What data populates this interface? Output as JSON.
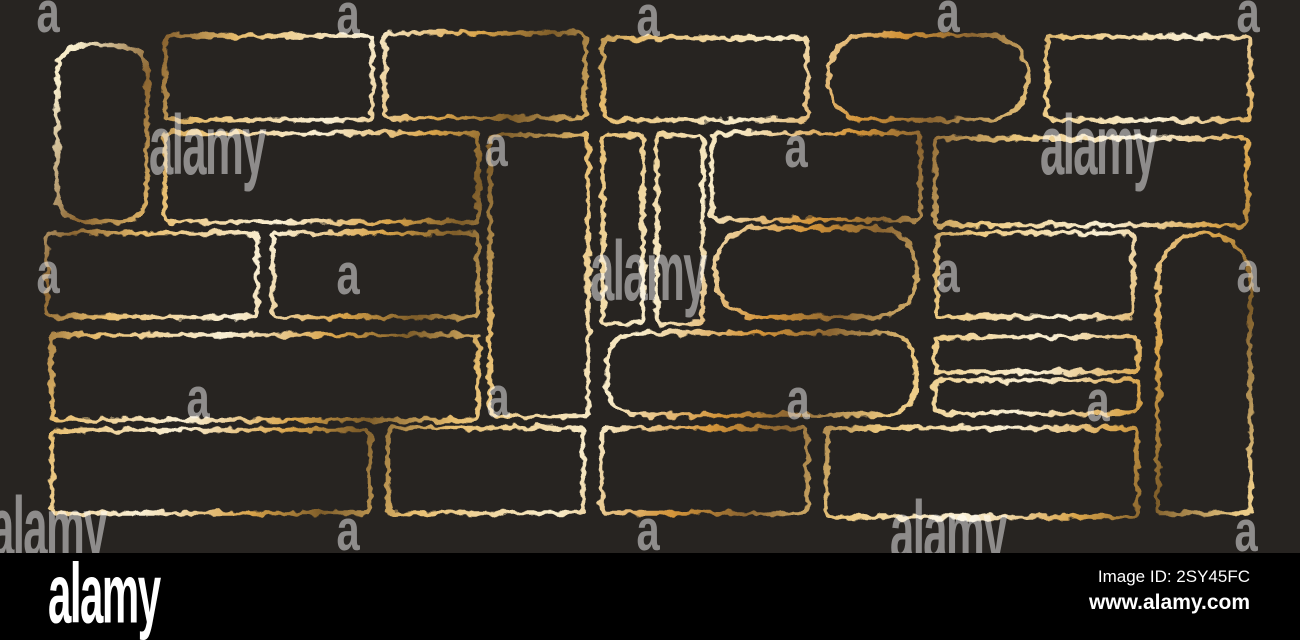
{
  "artwork": {
    "background": "#272421",
    "stroke_width": 4.6,
    "gold_gradient_stops": [
      {
        "offset": 0.0,
        "color": "#ecc87e"
      },
      {
        "offset": 0.06,
        "color": "#f8eecd"
      },
      {
        "offset": 0.115,
        "color": "#8a6430"
      },
      {
        "offset": 0.16,
        "color": "#e7bd6e"
      },
      {
        "offset": 0.24,
        "color": "#f9efd4"
      },
      {
        "offset": 0.31,
        "color": "#d9a44a"
      },
      {
        "offset": 0.355,
        "color": "#7d5c29"
      },
      {
        "offset": 0.41,
        "color": "#e7bd6e"
      },
      {
        "offset": 0.5,
        "color": "#f8ecca"
      },
      {
        "offset": 0.575,
        "color": "#d39439"
      },
      {
        "offset": 0.62,
        "color": "#8a6430"
      },
      {
        "offset": 0.68,
        "color": "#ecc87e"
      },
      {
        "offset": 0.76,
        "color": "#f9efd4"
      },
      {
        "offset": 0.83,
        "color": "#d9a44a"
      },
      {
        "offset": 0.875,
        "color": "#7d5c29"
      },
      {
        "offset": 0.93,
        "color": "#eccb85"
      },
      {
        "offset": 1.0,
        "color": "#f6e7c2"
      }
    ],
    "frames": [
      {
        "shape": "rounded",
        "x": 57,
        "y": 45,
        "w": 90,
        "h": 177,
        "rx": 28
      },
      {
        "shape": "rect",
        "x": 165,
        "y": 36,
        "w": 207,
        "h": 84,
        "rx": 5
      },
      {
        "shape": "rect",
        "x": 385,
        "y": 33,
        "w": 200,
        "h": 85,
        "rx": 5
      },
      {
        "shape": "rect",
        "x": 603,
        "y": 38,
        "w": 204,
        "h": 82,
        "rx": 5
      },
      {
        "shape": "pill",
        "x": 828,
        "y": 35,
        "w": 200,
        "h": 85,
        "rx": 40
      },
      {
        "shape": "rect",
        "x": 1047,
        "y": 37,
        "w": 203,
        "h": 83,
        "rx": 5
      },
      {
        "shape": "rect",
        "x": 165,
        "y": 133,
        "w": 313,
        "h": 89,
        "rx": 5
      },
      {
        "shape": "rect",
        "x": 490,
        "y": 135,
        "w": 98,
        "h": 281,
        "rx": 5
      },
      {
        "shape": "rect",
        "x": 603,
        "y": 135,
        "w": 40,
        "h": 188,
        "rx": 5
      },
      {
        "shape": "rect",
        "x": 657,
        "y": 135,
        "w": 46,
        "h": 188,
        "rx": 5
      },
      {
        "shape": "rect",
        "x": 712,
        "y": 133,
        "w": 208,
        "h": 87,
        "rx": 5
      },
      {
        "shape": "rect",
        "x": 935,
        "y": 138,
        "w": 312,
        "h": 87,
        "rx": 5
      },
      {
        "shape": "rect",
        "x": 47,
        "y": 233,
        "w": 210,
        "h": 84,
        "rx": 5
      },
      {
        "shape": "rect",
        "x": 273,
        "y": 233,
        "w": 205,
        "h": 84,
        "rx": 5
      },
      {
        "shape": "pill",
        "x": 715,
        "y": 228,
        "w": 202,
        "h": 89,
        "rx": 42
      },
      {
        "shape": "rect",
        "x": 937,
        "y": 233,
        "w": 196,
        "h": 84,
        "rx": 5
      },
      {
        "shape": "arch",
        "x": 1158,
        "y": 233,
        "w": 92,
        "h": 280,
        "rx": 46
      },
      {
        "shape": "rect",
        "x": 52,
        "y": 335,
        "w": 426,
        "h": 85,
        "rx": 5
      },
      {
        "shape": "rounded",
        "x": 607,
        "y": 333,
        "w": 308,
        "h": 82,
        "rx": 30
      },
      {
        "shape": "rect",
        "x": 935,
        "y": 337,
        "w": 203,
        "h": 35,
        "rx": 4
      },
      {
        "shape": "rect",
        "x": 935,
        "y": 380,
        "w": 203,
        "h": 33,
        "rx": 4
      },
      {
        "shape": "rect",
        "x": 52,
        "y": 430,
        "w": 318,
        "h": 83,
        "rx": 5
      },
      {
        "shape": "rect",
        "x": 388,
        "y": 428,
        "w": 195,
        "h": 85,
        "rx": 5
      },
      {
        "shape": "rect",
        "x": 602,
        "y": 428,
        "w": 205,
        "h": 85,
        "rx": 5
      },
      {
        "shape": "rect",
        "x": 827,
        "y": 428,
        "w": 310,
        "h": 89,
        "rx": 5
      }
    ]
  },
  "watermarks": {
    "color": "#ffffff",
    "opacity": 0.48,
    "alamy_text": "alamy",
    "a_text": "a",
    "alamy_marks": [
      {
        "x": 207,
        "y": 146
      },
      {
        "x": 1098,
        "y": 146
      },
      {
        "x": 648,
        "y": 272
      },
      {
        "x": 48,
        "y": 528
      },
      {
        "x": 948,
        "y": 532
      }
    ],
    "a_marks": [
      {
        "x": 47,
        "y": 12
      },
      {
        "x": 347,
        "y": 14
      },
      {
        "x": 647,
        "y": 16
      },
      {
        "x": 947,
        "y": 12
      },
      {
        "x": 1247,
        "y": 12
      },
      {
        "x": 495,
        "y": 146
      },
      {
        "x": 795,
        "y": 147
      },
      {
        "x": 47,
        "y": 273
      },
      {
        "x": 347,
        "y": 274
      },
      {
        "x": 947,
        "y": 272
      },
      {
        "x": 1247,
        "y": 272
      },
      {
        "x": 197,
        "y": 398
      },
      {
        "x": 497,
        "y": 397
      },
      {
        "x": 797,
        "y": 399
      },
      {
        "x": 1097,
        "y": 401
      },
      {
        "x": 347,
        "y": 530
      },
      {
        "x": 647,
        "y": 530
      },
      {
        "x": 1245,
        "y": 531
      }
    ]
  },
  "footer": {
    "background": "#000000",
    "text_color": "#ffffff",
    "logo": "alamy",
    "image_id": "Image ID: 2SY45FC",
    "url": "www.alamy.com"
  }
}
